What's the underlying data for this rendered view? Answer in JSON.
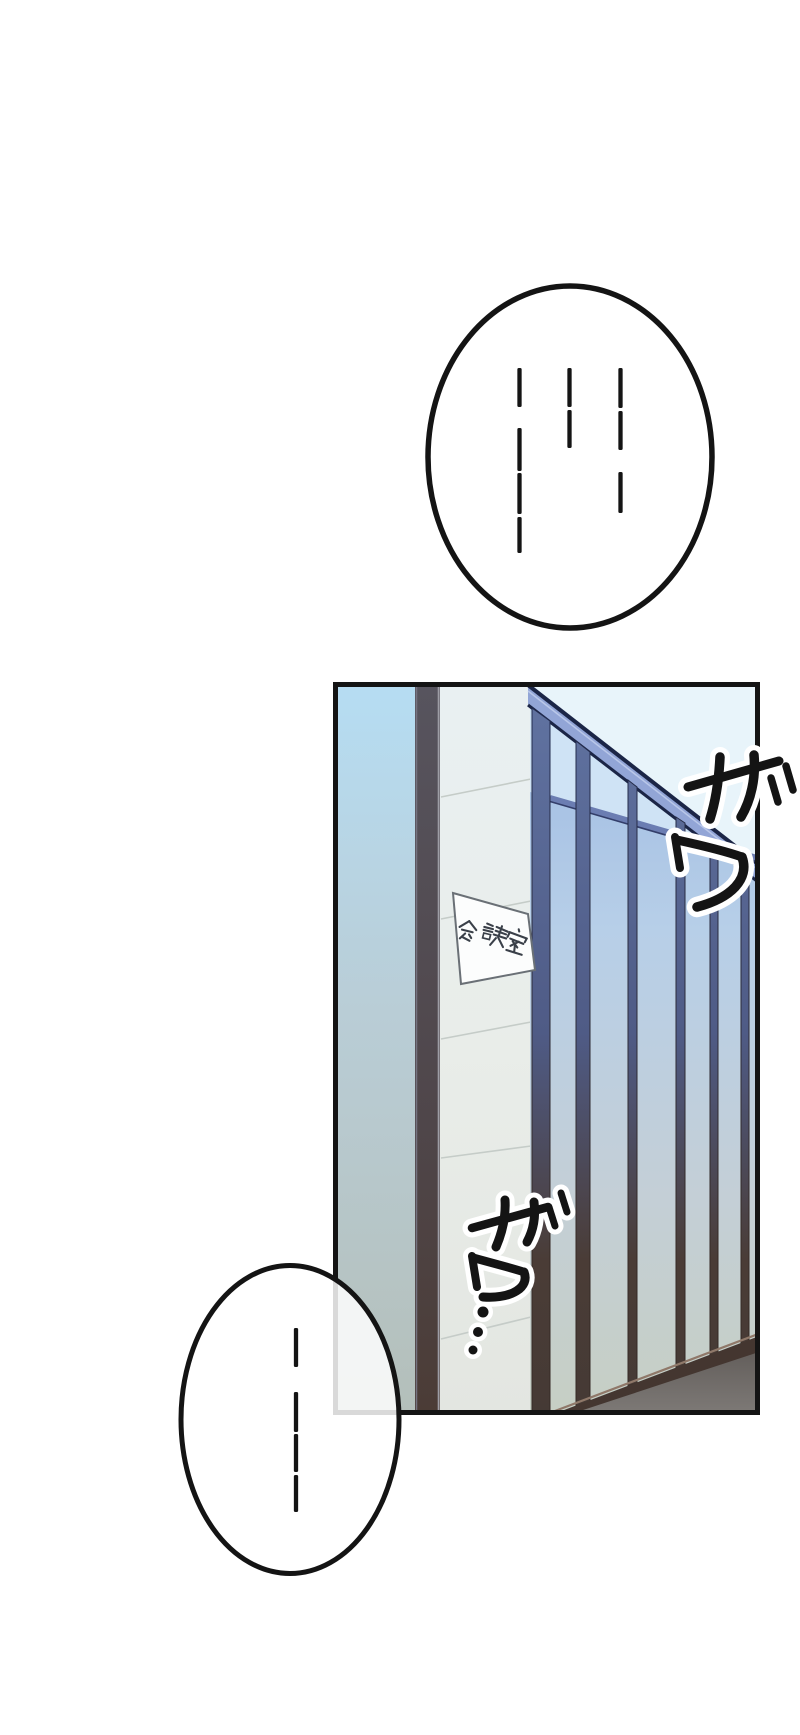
{
  "page": {
    "kind": "manga webtoon page",
    "width": 800,
    "height": 1735,
    "background": "#ffffff",
    "ink": "#141414"
  },
  "speech_bubbles": {
    "top": {
      "shape": "ellipse",
      "text": "……",
      "style": "vertical silence dashes, three columns",
      "ink": "#141414",
      "fill": "#ffffff",
      "fill_opacity": 0.85,
      "dash_width": 4.3,
      "dash_columns": [
        {
          "x": 519.5,
          "segments": [
            [
              368,
              407
            ],
            [
              428,
              471
            ],
            [
              473,
              514
            ],
            [
              517,
              553
            ]
          ]
        },
        {
          "x": 569.5,
          "segments": [
            [
              368,
              407
            ],
            [
              410,
              448
            ]
          ]
        },
        {
          "x": 620.5,
          "segments": [
            [
              368,
              408
            ],
            [
              411,
              450
            ],
            [
              472,
              513
            ]
          ]
        }
      ]
    },
    "bottom": {
      "shape": "ellipse",
      "text": "……",
      "style": "vertical silence dashes, one column, bubble semi-transparent over panel corner",
      "ink": "#141414",
      "fill": "#ffffff",
      "fill_opacity": 0.84,
      "dash_width": 4.3,
      "dash_columns": [
        {
          "x": 296,
          "segments": [
            [
              1328,
              1367
            ],
            [
              1392,
              1432
            ],
            [
              1434,
              1472
            ],
            [
              1475,
              1512
            ]
          ]
        }
      ]
    }
  },
  "panel": {
    "description": "office hallway: dark-edged pillar with tiled face and meeting-room sign, glass wall receding right, dark floor lower right",
    "border_color": "#141414",
    "sign": {
      "text": "会議室",
      "background": "#fcfdfd",
      "border_color": "#6a7076",
      "text_color": "#3a4049"
    },
    "sfx": [
      {
        "text": "ザワ",
        "location": "top-right, crossing panel border",
        "color": "#141414",
        "outline": "#ffffff"
      },
      {
        "text": "ザワ",
        "trailing_dots": 3,
        "location": "center, over pillar",
        "color": "#141414",
        "outline": "#ffffff"
      }
    ],
    "colors": {
      "left_wall_top": "#b6ddf3",
      "left_wall_bottom": "#b4bfba",
      "pillar_dark_top": "#57545e",
      "pillar_dark_bottom": "#4b3c36",
      "tile_top": "#ebf1f0",
      "tile_bottom": "#e3e6e1",
      "ceiling_pale": "#e8f4fa",
      "beam": "#92a5d6",
      "beam_edge": "#1b2546",
      "glass_top": "#9db9e2",
      "glass_bottom": "#c6cfc4",
      "mullion_top": "#5f719f",
      "mullion_bottom": "#453a35",
      "rail": "#443630",
      "rail_highlight": "#8f7869",
      "floor_top": "#5e5956",
      "floor_bottom": "#7e7a77"
    }
  }
}
